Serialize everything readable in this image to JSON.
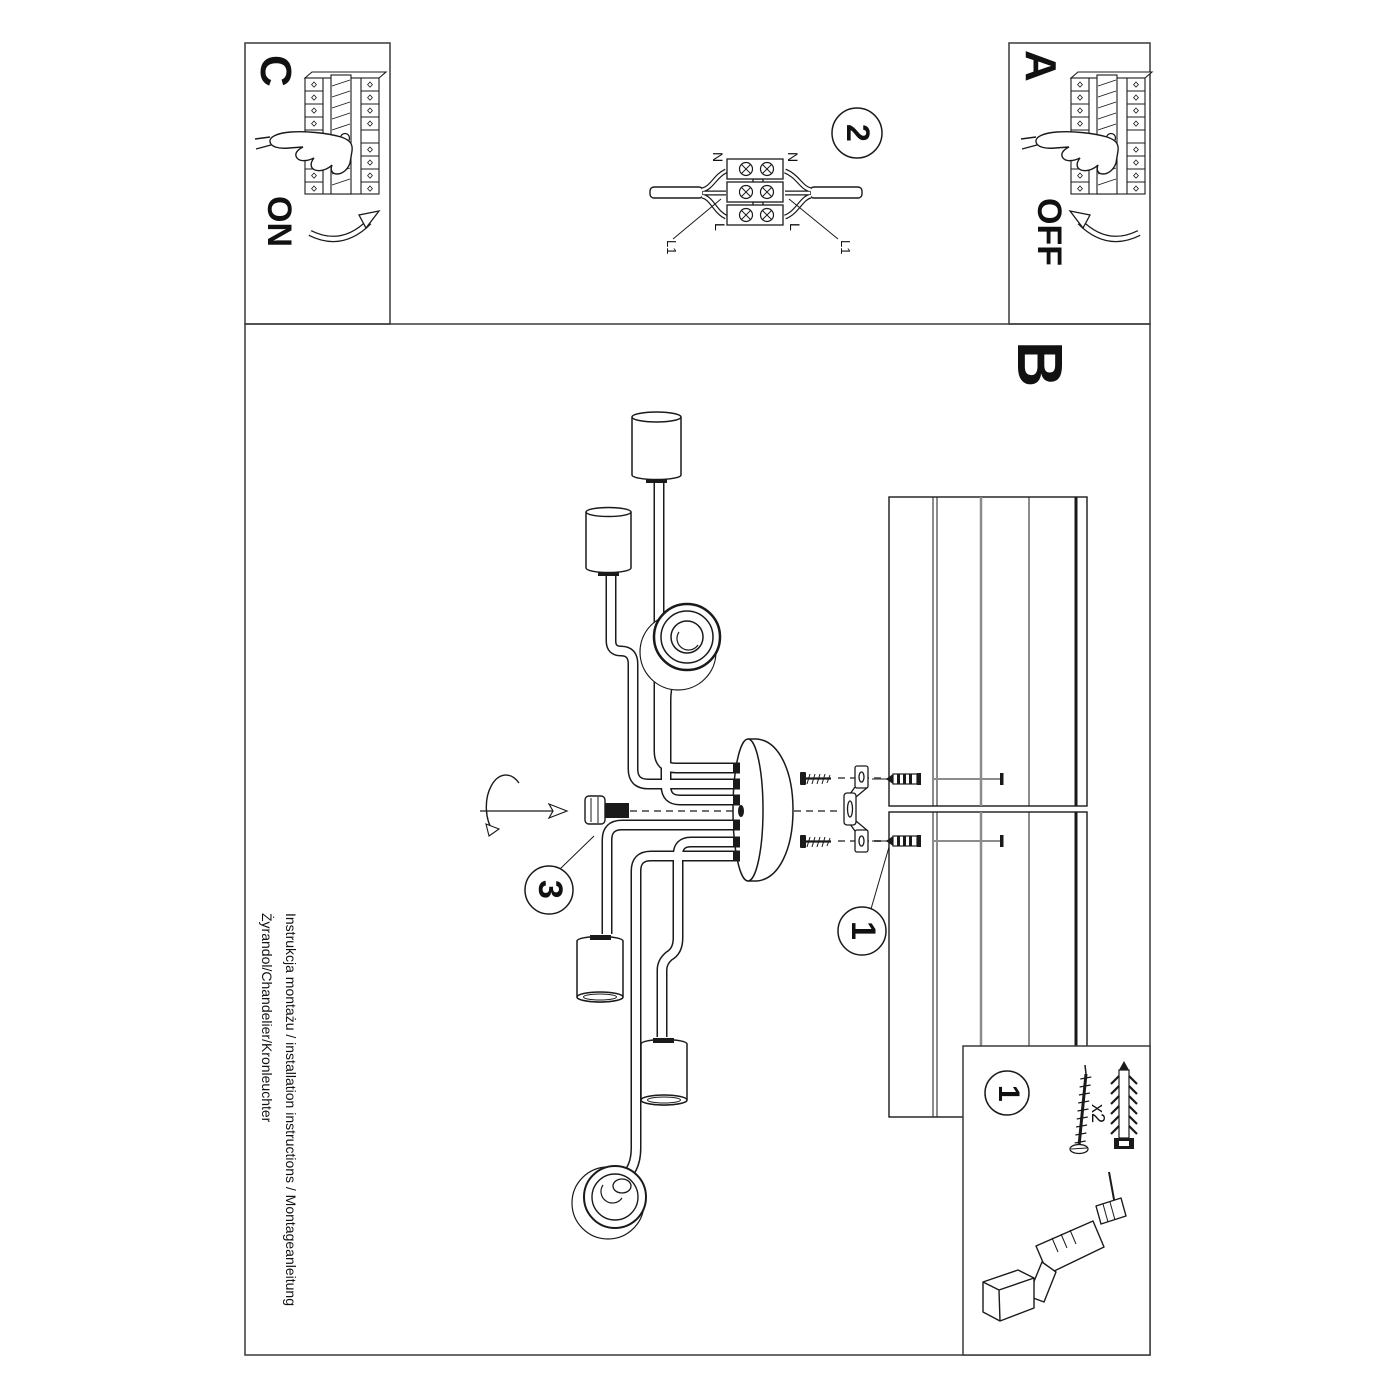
{
  "document": {
    "footer_line1": "Instrukcja montażu / installation instructions / Montageanleitung",
    "footer_line2": "Żyrandol/Chandelier/Kronleuchter"
  },
  "steps": {
    "a_label": "A",
    "a_action": "OFF",
    "b_label": "B",
    "c_label": "C",
    "c_action": "ON",
    "step1_number": "1",
    "step2_number": "2",
    "step3_number": "3"
  },
  "wiring_diagram": {
    "neutral_left": "N",
    "neutral_right": "N",
    "live_left": "L",
    "live_right": "L",
    "l1_left": "L1",
    "l1_right": "L1"
  },
  "parts_box": {
    "step_number": "1",
    "quantity": "x2"
  },
  "colors": {
    "line": "#1a1a1a",
    "gray": "#8c8c8c",
    "background": "#ffffff"
  }
}
